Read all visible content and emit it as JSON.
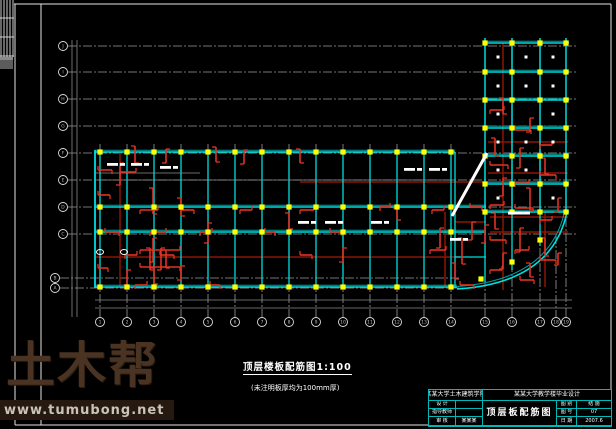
{
  "watermark": {
    "logo": "土木帮",
    "url": "www.tumubong.net"
  },
  "caption": {
    "line1": "顶层楼板配筋图1:100",
    "line2": "(未注明板厚均为100mm厚)"
  },
  "titleblock": {
    "school": "某某大学土木建筑学院",
    "project": "某某大学教学楼毕业设计",
    "drawing_title": "顶层板配筋图",
    "left_rows": [
      {
        "label": "设 计",
        "value": ""
      },
      {
        "label": "指导教师",
        "value": ""
      },
      {
        "label": "审 核",
        "value": "某某某"
      }
    ],
    "right_rows": [
      {
        "label": "图 别",
        "value": "结 施"
      },
      {
        "label": "图 号",
        "value": "07"
      },
      {
        "label": "日 期",
        "value": "2007.6"
      }
    ]
  },
  "colors": {
    "beam": "#00dede",
    "beam_dark": "#00a0a0",
    "column": "#ffff00",
    "rebar": "#e03224",
    "rebar_dark": "#8c1505",
    "axis": "#9a9a9a",
    "frame": "#e4e4e4",
    "white": "#ffffff",
    "table": "#00b8b8"
  },
  "plan": {
    "frame_lines": [
      [
        14,
        4,
        611,
        4
      ],
      [
        15,
        4,
        15,
        425
      ],
      [
        611,
        4,
        611,
        425
      ],
      [
        15,
        425,
        611,
        425
      ],
      [
        41,
        4,
        41,
        425
      ]
    ],
    "strip": {
      "x": 0,
      "y": 0,
      "w": 14,
      "h": 57,
      "vlines": [
        1,
        4,
        7,
        10,
        13
      ],
      "hlines": [
        18,
        37,
        56
      ],
      "block": [
        0,
        57,
        13,
        12
      ]
    },
    "h_axes": [
      {
        "y": 46,
        "l": "J"
      },
      {
        "y": 72,
        "l": "I"
      },
      {
        "y": 99,
        "l": "H"
      },
      {
        "y": 126,
        "l": "G"
      },
      {
        "y": 153,
        "l": "F"
      },
      {
        "y": 180,
        "l": "E"
      },
      {
        "y": 207,
        "l": "D"
      },
      {
        "y": 234,
        "l": "C"
      },
      {
        "y": 278,
        "l": "B",
        "cx": 55,
        "x2": 460
      },
      {
        "y": 288,
        "l": "A",
        "cx": 55,
        "x2": 460
      }
    ],
    "h_axis_cx": 63,
    "h_axis_x2": 578,
    "v_axes": [
      {
        "x": 100,
        "l": "1",
        "yt": 144
      },
      {
        "x": 127,
        "l": "2",
        "yt": 144
      },
      {
        "x": 154,
        "l": "3",
        "yt": 144
      },
      {
        "x": 181,
        "l": "4",
        "yt": 144
      },
      {
        "x": 208,
        "l": "5",
        "yt": 144
      },
      {
        "x": 235,
        "l": "6",
        "yt": 144
      },
      {
        "x": 262,
        "l": "7",
        "yt": 144
      },
      {
        "x": 289,
        "l": "8",
        "yt": 144
      },
      {
        "x": 316,
        "l": "9",
        "yt": 144
      },
      {
        "x": 343,
        "l": "10",
        "yt": 144
      },
      {
        "x": 370,
        "l": "11",
        "yt": 144
      },
      {
        "x": 397,
        "l": "12",
        "yt": 144
      },
      {
        "x": 424,
        "l": "13",
        "yt": 144
      },
      {
        "x": 451,
        "l": "14",
        "yt": 144
      },
      {
        "x": 485,
        "l": "15",
        "yt": 38
      },
      {
        "x": 512,
        "l": "16",
        "yt": 38
      },
      {
        "x": 540,
        "l": "17",
        "yt": 38
      },
      {
        "x": 556,
        "l": "18",
        "yt": 235
      },
      {
        "x": 566,
        "l": "19",
        "yt": 38
      }
    ],
    "v_axis_cy": 322,
    "dim_lines": [
      [
        95,
        300,
        572,
        300
      ],
      [
        95,
        308,
        572,
        308
      ],
      [
        72,
        40,
        72,
        317
      ],
      [
        77,
        40,
        77,
        317
      ]
    ],
    "wing": {
      "x1": 95,
      "x2": 455,
      "rows": [
        {
          "y": 152,
          "x2": 455
        },
        {
          "y": 207,
          "x2": 486
        },
        {
          "y": 232,
          "x2": 486
        },
        {
          "y": 287,
          "x2": 457
        }
      ],
      "cols": [
        100,
        127,
        154,
        181,
        208,
        235,
        262,
        289,
        316,
        343,
        370,
        397,
        424,
        451
      ],
      "col_y1": 150,
      "col_y2": 288,
      "sec_lines": [
        [
          95,
          173,
          200,
          173
        ],
        [
          95,
          180,
          455,
          180
        ]
      ]
    },
    "tower": {
      "x1": 483,
      "x2": 569,
      "rows": [
        43,
        72,
        100,
        128,
        156,
        184,
        212
      ],
      "cols": [
        485,
        512,
        540,
        566
      ],
      "col_y1": 38,
      "col_y2": 212,
      "ext_cols": [
        [
          485,
          212,
          282
        ],
        [
          512,
          212,
          270
        ],
        [
          540,
          212,
          246
        ]
      ]
    },
    "arc": {
      "outer": "M457 289 Q 552 283 567 212",
      "inner": "M457 286.5 Q 549 280 564.5 212"
    },
    "arc_columns": [
      [
        481,
        279
      ],
      [
        512,
        262
      ],
      [
        540,
        240
      ]
    ],
    "corridor_beams": [
      [
        455,
        257,
        486,
        257
      ]
    ],
    "marks": {
      "vb": [
        [
          135,
          146,
          17
        ],
        [
          166,
          149,
          14
        ],
        [
          216,
          147,
          15
        ],
        [
          244,
          150,
          14
        ],
        [
          300,
          149,
          14
        ],
        [
          120,
          163,
          22
        ],
        [
          153,
          188,
          26
        ],
        [
          153,
          238,
          24
        ],
        [
          181,
          198,
          18
        ],
        [
          208,
          223,
          20
        ],
        [
          166,
          250,
          18
        ],
        [
          127,
          270,
          15
        ],
        [
          154,
          268,
          16
        ],
        [
          181,
          266,
          14
        ],
        [
          289,
          213,
          16
        ],
        [
          343,
          248,
          14
        ],
        [
          397,
          208,
          12
        ],
        [
          440,
          228,
          20
        ],
        [
          462,
          238,
          26
        ],
        [
          472,
          222,
          18
        ],
        [
          455,
          263,
          16
        ],
        [
          485,
          225,
          18
        ],
        [
          503,
          98,
          16
        ],
        [
          530,
          118,
          14
        ],
        [
          495,
          138,
          18
        ],
        [
          520,
          148,
          20
        ],
        [
          545,
          158,
          16
        ],
        [
          503,
          178,
          18
        ],
        [
          530,
          188,
          22
        ],
        [
          558,
          198,
          14
        ],
        [
          495,
          213,
          16
        ],
        [
          520,
          228,
          24
        ],
        [
          545,
          238,
          18
        ],
        [
          503,
          253,
          16
        ],
        [
          530,
          263,
          14
        ],
        [
          558,
          253,
          12
        ],
        [
          150,
          248,
          22
        ],
        [
          161,
          248,
          22
        ]
      ],
      "hb": [
        [
          98,
          170,
          14
        ],
        [
          120,
          172,
          16
        ],
        [
          98,
          195,
          12
        ],
        [
          140,
          210,
          18
        ],
        [
          105,
          232,
          14
        ],
        [
          125,
          255,
          12
        ],
        [
          98,
          268,
          10
        ],
        [
          150,
          232,
          16
        ],
        [
          180,
          210,
          14
        ],
        [
          200,
          232,
          12
        ],
        [
          160,
          255,
          14
        ],
        [
          135,
          285,
          12
        ],
        [
          210,
          285,
          10
        ],
        [
          240,
          210,
          12
        ],
        [
          265,
          232,
          10
        ],
        [
          300,
          210,
          14
        ],
        [
          330,
          232,
          12
        ],
        [
          380,
          207,
          10
        ],
        [
          300,
          255,
          12
        ],
        [
          430,
          250,
          16
        ],
        [
          460,
          285,
          14
        ],
        [
          432,
          210,
          12
        ],
        [
          470,
          207,
          12
        ],
        [
          490,
          110,
          14
        ],
        [
          515,
          130,
          16
        ],
        [
          540,
          145,
          12
        ],
        [
          490,
          165,
          18
        ],
        [
          515,
          183,
          14
        ],
        [
          540,
          175,
          16
        ],
        [
          490,
          205,
          14
        ],
        [
          515,
          208,
          18
        ],
        [
          540,
          220,
          12
        ],
        [
          490,
          240,
          16
        ],
        [
          515,
          250,
          14
        ],
        [
          540,
          260,
          16
        ],
        [
          490,
          270,
          12
        ],
        [
          520,
          280,
          14
        ],
        [
          140,
          250,
          40
        ],
        [
          140,
          267,
          40
        ]
      ],
      "dark": [
        [
          120,
          152,
          120,
          287
        ],
        [
          503,
          43,
          503,
          290
        ],
        [
          545,
          212,
          545,
          287
        ],
        [
          445,
          212,
          445,
          287
        ],
        [
          96,
          257,
          460,
          257
        ],
        [
          300,
          182,
          560,
          182
        ],
        [
          488,
          142,
          568,
          142
        ],
        [
          488,
          173,
          568,
          173
        ],
        [
          455,
          222,
          486,
          222
        ],
        [
          490,
          217,
          568,
          217
        ],
        [
          490,
          232,
          568,
          232
        ]
      ]
    },
    "slab_dots": [
      [
        498,
        57
      ],
      [
        526,
        57
      ],
      [
        553,
        57
      ],
      [
        498,
        86
      ],
      [
        526,
        86
      ],
      [
        553,
        86
      ],
      [
        498,
        114
      ],
      [
        553,
        114
      ],
      [
        498,
        142
      ],
      [
        526,
        142
      ],
      [
        553,
        142
      ],
      [
        526,
        170
      ],
      [
        498,
        170
      ],
      [
        553,
        198
      ],
      [
        498,
        198
      ]
    ],
    "white_labels": [
      [
        107,
        163
      ],
      [
        131,
        163
      ],
      [
        160,
        166
      ],
      [
        404,
        168
      ],
      [
        429,
        168
      ],
      [
        298,
        221
      ],
      [
        325,
        221
      ],
      [
        371,
        221
      ],
      [
        450,
        238
      ]
    ],
    "white_circles": [
      [
        100,
        252
      ],
      [
        124,
        252
      ]
    ],
    "white_thick": [
      [
        452,
        216,
        487,
        153
      ],
      [
        508,
        213,
        530,
        213
      ]
    ]
  }
}
